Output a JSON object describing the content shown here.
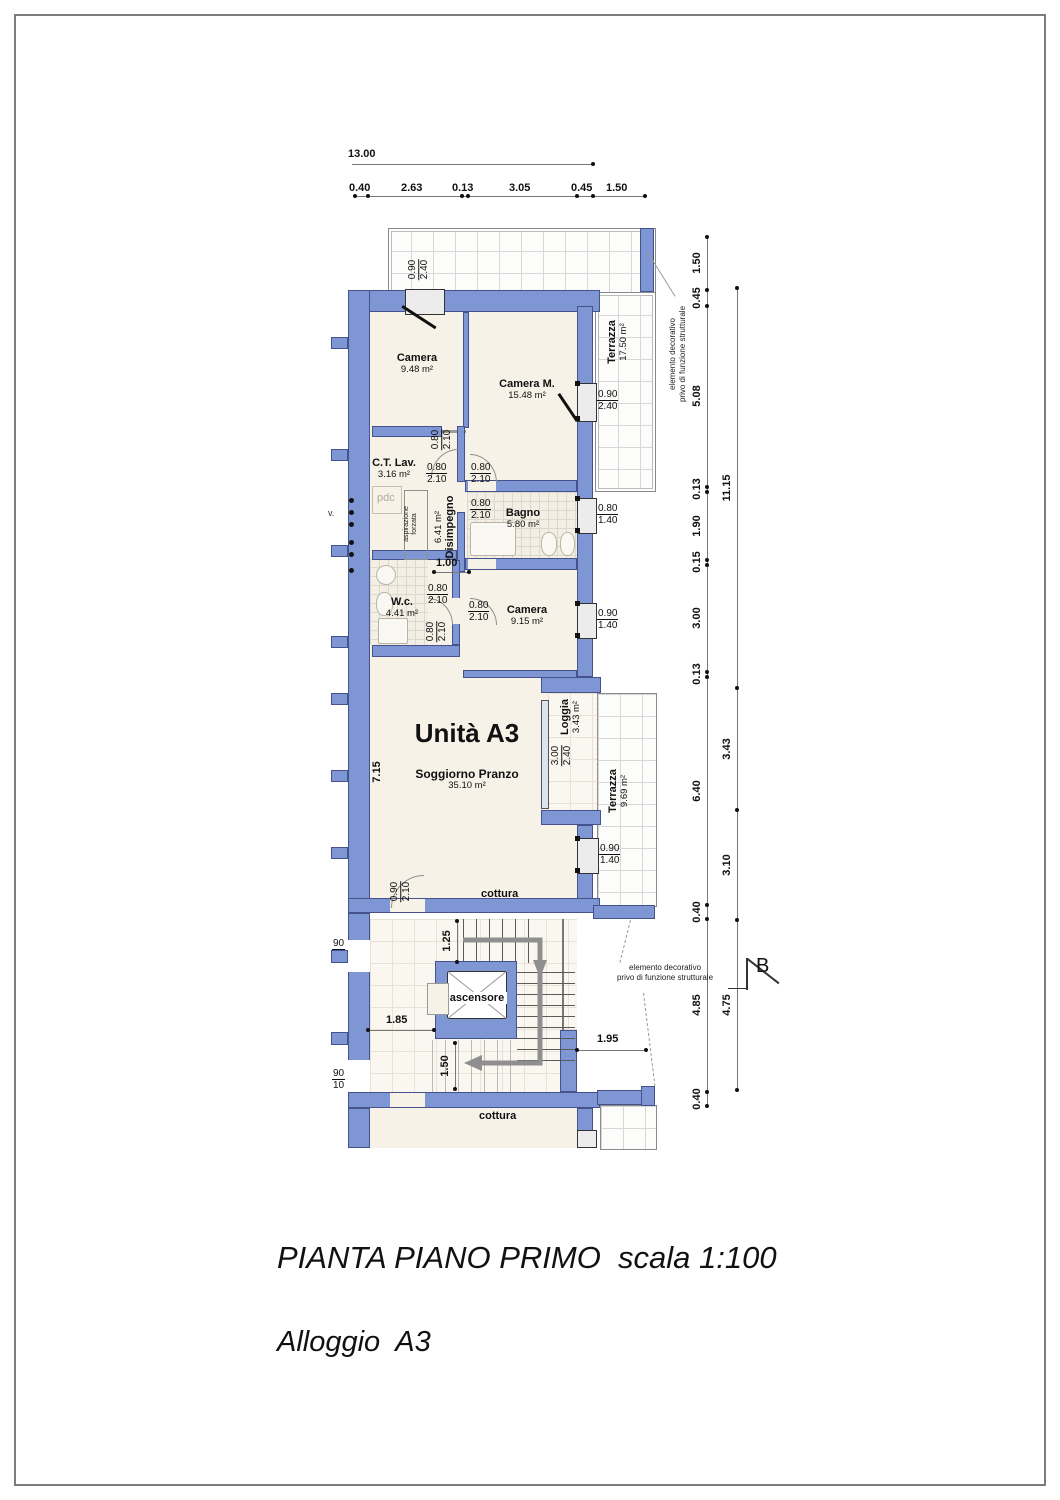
{
  "sheet": {
    "title": "PIANTA PIANO PRIMO  scala 1:100",
    "subtitle": "Alloggio  A3",
    "unit_label": "Unità A3"
  },
  "rooms": {
    "camera1": {
      "name": "Camera",
      "area": "9.48 m²"
    },
    "cameraM": {
      "name": "Camera M.",
      "area": "15.48 m²"
    },
    "terrazza1": {
      "name": "Terrazza",
      "area": "17.50 m²"
    },
    "ctlav": {
      "name": "C.T. Lav.",
      "area": "3.16 m²"
    },
    "disimpegno": {
      "name": "Disimpegno",
      "area": "6.41 m²"
    },
    "bagno": {
      "name": "Bagno",
      "area": "5.80 m²"
    },
    "wc": {
      "name": "W.c.",
      "area": "4.41 m²"
    },
    "camera2": {
      "name": "Camera",
      "area": "9.15 m²"
    },
    "soggiorno": {
      "name": "Soggiorno Pranzo",
      "area": "35.10 m²"
    },
    "loggia": {
      "name": "Loggia",
      "area": "3.43 m²"
    },
    "terrazza2": {
      "name": "Terrazza",
      "area": "9.69 m²"
    },
    "vano_scala": {
      "name": "Vano scala",
      "area": "12.40 m²"
    },
    "ascensore": {
      "name": "ascensore"
    }
  },
  "small_labels": {
    "pdc": "pdc",
    "asp1": "aspirazione",
    "asp2": "forzata",
    "cut_v": "v.",
    "cottura_top": "cottura",
    "cottura_bottom": "cottura"
  },
  "notes": {
    "deco_line1": "elemento decorativo",
    "deco_line2": "privo di funzione strutturale",
    "section_mark": "B"
  },
  "dims": {
    "total": "13.00",
    "top": [
      "0.40",
      "2.63",
      "0.13",
      "3.05",
      "0.45",
      "1.50"
    ],
    "right_inner": [
      "1.50",
      "0.45",
      "5.08",
      "0.13",
      "1.90",
      "0.15",
      "3.00",
      "0.13",
      "6.40",
      "0.40",
      "4.85",
      "0.40"
    ],
    "right_outer": [
      "11.15",
      "3.43",
      "3.10",
      "4.75"
    ],
    "inner": {
      "corridor": "1.00",
      "soggiorno_h": "7.15",
      "stair_top": "1.25",
      "stair_left": "1.85",
      "stair_bottom": "1.50",
      "stair_right": "1.95"
    }
  },
  "openings": {
    "win_camera_top": {
      "w": "0.90",
      "h": "2.40"
    },
    "door_pocket": {
      "w": "0.80",
      "h": "2.10"
    },
    "door_ctlav": {
      "w": "0.80",
      "h": "2.10"
    },
    "door_cameram": {
      "w": "0.80",
      "h": "2.10"
    },
    "door_bagno": {
      "w": "0.80",
      "h": "2.10"
    },
    "win_bagno": {
      "w": "0.80",
      "h": "1.40"
    },
    "win_cameram": {
      "w": "0.90",
      "h": "2.40"
    },
    "door_wc": {
      "w": "0.80",
      "h": "2.10"
    },
    "door_wc2": {
      "w": "0.80",
      "h": "2.10"
    },
    "door_camera2": {
      "w": "0.80",
      "h": "2.10"
    },
    "win_camera2": {
      "w": "0.90",
      "h": "1.40"
    },
    "glass_loggia": {
      "w": "3.00",
      "h": "2.40"
    },
    "win_soggiorno": {
      "w": "0.90",
      "h": "1.40"
    },
    "door_soggiorno": {
      "w": "0.90",
      "h": "2.10"
    },
    "door_cottura": {
      "w": "0.90",
      "h": "2.10"
    },
    "door_scala_up": {
      "w": "90",
      "h": "10"
    },
    "door_scala_dn": {
      "w": "90",
      "h": "10"
    }
  },
  "colors": {
    "wall": "#7e97d4",
    "room_fill": "#f6f2e8",
    "grid_line": "#d7d7d7"
  }
}
